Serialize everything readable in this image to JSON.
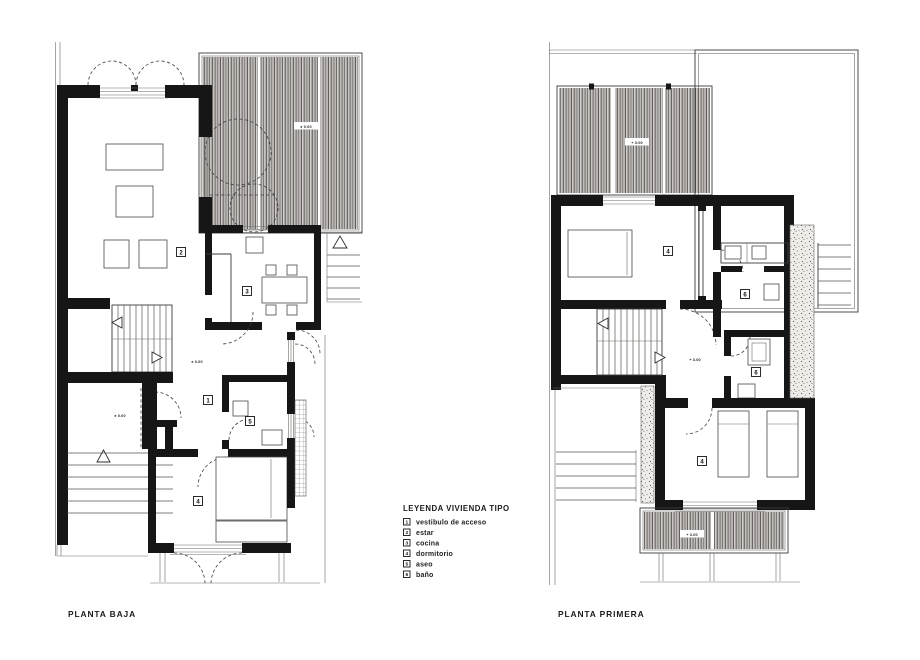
{
  "titles": {
    "left": "PLANTA BAJA",
    "right": "PLANTA PRIMERA"
  },
  "legend": {
    "title": "LEYENDA VIVIENDA TIPO",
    "items": [
      {
        "num": "1",
        "label": "vestibulo de acceso"
      },
      {
        "num": "2",
        "label": "estar"
      },
      {
        "num": "3",
        "label": "cocina"
      },
      {
        "num": "4",
        "label": "dormitorio"
      },
      {
        "num": "5",
        "label": "aseo"
      },
      {
        "num": "6",
        "label": "baño"
      }
    ]
  },
  "plans": {
    "baja": {
      "rooms": {
        "estar": "2",
        "cocina": "3",
        "vestibulo": "1",
        "aseo": "5",
        "dormitorio": "4"
      },
      "levels": {
        "terraza": "± 0.00",
        "vestibulo": "± 0.00",
        "acceso": "± 0.00"
      }
    },
    "primera": {
      "rooms": {
        "dormitorio_norte": "4",
        "bano_norte": "6",
        "bano_sur": "6",
        "dormitorio_sur": "4"
      },
      "levels": {
        "terraza": "+ 3.00",
        "distribuidor": "+ 3.00",
        "balcon": "+ 3.00"
      }
    }
  },
  "colors": {
    "ink": "#161616",
    "hatch_dark": "#4c4743",
    "hatch_light": "#8d8680"
  }
}
